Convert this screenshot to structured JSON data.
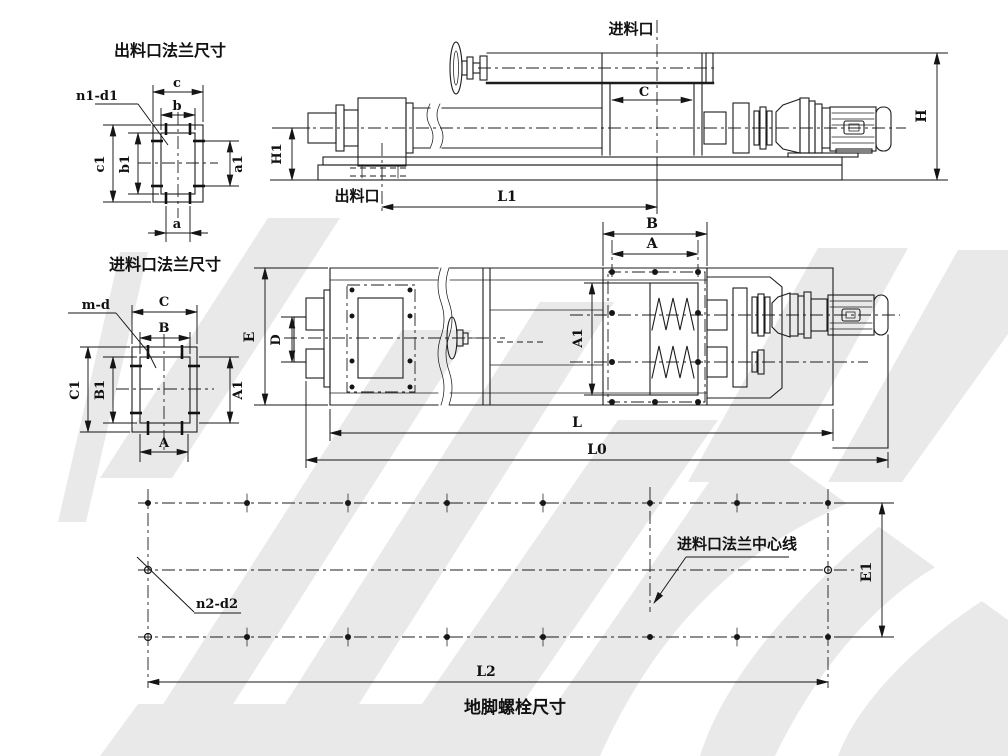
{
  "outlet_flange_view": {
    "title": "出料口法兰尺寸",
    "bolt_label": "n1-d1",
    "dim_top_outer": "c",
    "dim_top_inner": "b",
    "dim_left_outer": "c1",
    "dim_left_inner": "b1",
    "dim_right": "a1",
    "dim_bottom": "a"
  },
  "inlet_flange_view": {
    "title": "进料口法兰尺寸",
    "bolt_label": "m-d",
    "dim_top_outer": "C",
    "dim_top_inner": "B",
    "dim_left_outer": "C1",
    "dim_left_inner": "B1",
    "dim_right": "A1",
    "dim_bottom": "A"
  },
  "side_view": {
    "inlet_port_label": "进料口",
    "outlet_port_label": "出料口",
    "dim_inlet_width": "C",
    "dim_length": "L1",
    "dim_height": "H",
    "dim_outlet_height": "H1"
  },
  "plan_view": {
    "dim_flange_outer": "B",
    "dim_flange_bolt_span": "A",
    "dim_body_width": "E",
    "dim_outlet_width": "D",
    "dim_inlet_opening": "A1",
    "dim_body_length": "L",
    "dim_total_length": "L0"
  },
  "bolt_layout_view": {
    "title": "地脚螺栓尺寸",
    "bolt_label": "n2-d2",
    "centerline_label": "进料口法兰中心线",
    "dim_row_span": "E1",
    "dim_length": "L2"
  }
}
